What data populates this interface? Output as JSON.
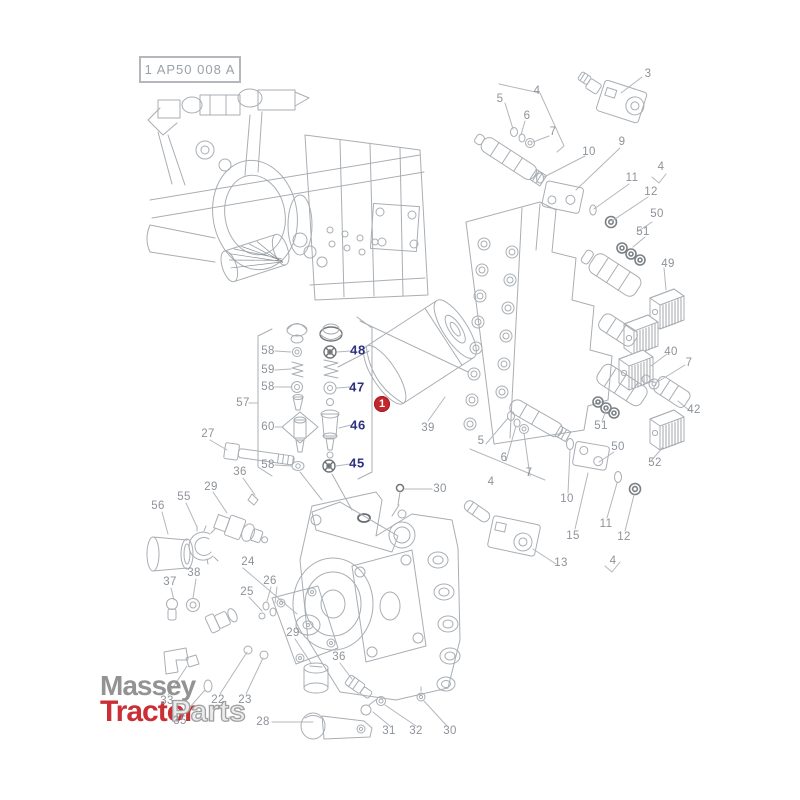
{
  "header": {
    "code": "1 AP50 008 A"
  },
  "highlight": {
    "number": "1",
    "color": "#c1272d"
  },
  "logo": {
    "line1": "Massey",
    "line2_red": "Tractor",
    "line2_outline": "Parts"
  },
  "colors": {
    "line": "#a9aeb3",
    "label": "#8d939a",
    "navy_label": "#2d3180",
    "badge_red": "#c1272d",
    "logo_red": "#c8242b",
    "logo_gray": "#8e8e8e"
  },
  "labels": [
    {
      "t": "3",
      "x": 648,
      "y": 74,
      "s": "gray"
    },
    {
      "t": "5",
      "x": 500,
      "y": 99,
      "s": "gray"
    },
    {
      "t": "6",
      "x": 527,
      "y": 116,
      "s": "gray"
    },
    {
      "t": "7",
      "x": 553,
      "y": 132,
      "s": "gray"
    },
    {
      "t": "4",
      "x": 537,
      "y": 91,
      "s": "gray"
    },
    {
      "t": "10",
      "x": 589,
      "y": 152,
      "s": "gray"
    },
    {
      "t": "9",
      "x": 622,
      "y": 142,
      "s": "gray"
    },
    {
      "t": "11",
      "x": 632,
      "y": 178,
      "s": "gray"
    },
    {
      "t": "12",
      "x": 651,
      "y": 192,
      "s": "gray"
    },
    {
      "t": "4",
      "x": 661,
      "y": 167,
      "s": "gray"
    },
    {
      "t": "50",
      "x": 657,
      "y": 214,
      "s": "gray"
    },
    {
      "t": "51",
      "x": 643,
      "y": 232,
      "s": "gray"
    },
    {
      "t": "49",
      "x": 668,
      "y": 264,
      "s": "gray"
    },
    {
      "t": "40",
      "x": 671,
      "y": 352,
      "s": "gray"
    },
    {
      "t": "7",
      "x": 689,
      "y": 363,
      "s": "gray"
    },
    {
      "t": "42",
      "x": 694,
      "y": 410,
      "s": "gray"
    },
    {
      "t": "51",
      "x": 601,
      "y": 426,
      "s": "gray"
    },
    {
      "t": "50",
      "x": 618,
      "y": 447,
      "s": "gray"
    },
    {
      "t": "52",
      "x": 655,
      "y": 463,
      "s": "gray"
    },
    {
      "t": "48",
      "x": 358,
      "y": 350,
      "s": "navy"
    },
    {
      "t": "47",
      "x": 357,
      "y": 387,
      "s": "navy"
    },
    {
      "t": "46",
      "x": 358,
      "y": 425,
      "s": "navy"
    },
    {
      "t": "45",
      "x": 357,
      "y": 463,
      "s": "navy"
    },
    {
      "t": "58",
      "x": 268,
      "y": 351,
      "s": "gray"
    },
    {
      "t": "59",
      "x": 268,
      "y": 370,
      "s": "gray"
    },
    {
      "t": "58",
      "x": 268,
      "y": 387,
      "s": "gray"
    },
    {
      "t": "57",
      "x": 243,
      "y": 403,
      "s": "gray"
    },
    {
      "t": "60",
      "x": 268,
      "y": 427,
      "s": "gray"
    },
    {
      "t": "58",
      "x": 268,
      "y": 465,
      "s": "gray"
    },
    {
      "t": "1",
      "x": 382,
      "y": 404,
      "s": "badge"
    },
    {
      "t": "39",
      "x": 428,
      "y": 428,
      "s": "gray"
    },
    {
      "t": "27",
      "x": 208,
      "y": 434,
      "s": "gray"
    },
    {
      "t": "36",
      "x": 240,
      "y": 472,
      "s": "gray"
    },
    {
      "t": "30",
      "x": 440,
      "y": 489,
      "s": "gray"
    },
    {
      "t": "29",
      "x": 211,
      "y": 487,
      "s": "gray"
    },
    {
      "t": "55",
      "x": 184,
      "y": 497,
      "s": "gray"
    },
    {
      "t": "56",
      "x": 158,
      "y": 506,
      "s": "gray"
    },
    {
      "t": "37",
      "x": 170,
      "y": 582,
      "s": "gray"
    },
    {
      "t": "38",
      "x": 194,
      "y": 573,
      "s": "gray"
    },
    {
      "t": "24",
      "x": 248,
      "y": 562,
      "s": "gray"
    },
    {
      "t": "25",
      "x": 247,
      "y": 592,
      "s": "gray"
    },
    {
      "t": "26",
      "x": 270,
      "y": 581,
      "s": "gray"
    },
    {
      "t": "33",
      "x": 167,
      "y": 701,
      "s": "gray"
    },
    {
      "t": "22",
      "x": 218,
      "y": 700,
      "s": "gray"
    },
    {
      "t": "23",
      "x": 245,
      "y": 700,
      "s": "gray"
    },
    {
      "t": "35",
      "x": 180,
      "y": 721,
      "s": "gray"
    },
    {
      "t": "28",
      "x": 263,
      "y": 722,
      "s": "gray"
    },
    {
      "t": "29",
      "x": 293,
      "y": 633,
      "s": "gray"
    },
    {
      "t": "36",
      "x": 339,
      "y": 657,
      "s": "gray"
    },
    {
      "t": "31",
      "x": 389,
      "y": 731,
      "s": "gray"
    },
    {
      "t": "32",
      "x": 416,
      "y": 731,
      "s": "gray"
    },
    {
      "t": "30",
      "x": 450,
      "y": 731,
      "s": "gray"
    },
    {
      "t": "5",
      "x": 481,
      "y": 441,
      "s": "gray"
    },
    {
      "t": "6",
      "x": 504,
      "y": 458,
      "s": "gray"
    },
    {
      "t": "7",
      "x": 529,
      "y": 473,
      "s": "gray"
    },
    {
      "t": "4",
      "x": 491,
      "y": 482,
      "s": "gray"
    },
    {
      "t": "10",
      "x": 567,
      "y": 499,
      "s": "gray"
    },
    {
      "t": "15",
      "x": 573,
      "y": 536,
      "s": "gray"
    },
    {
      "t": "11",
      "x": 606,
      "y": 524,
      "s": "gray"
    },
    {
      "t": "12",
      "x": 624,
      "y": 537,
      "s": "gray"
    },
    {
      "t": "13",
      "x": 561,
      "y": 563,
      "s": "gray"
    },
    {
      "t": "4",
      "x": 613,
      "y": 561,
      "s": "gray"
    }
  ]
}
